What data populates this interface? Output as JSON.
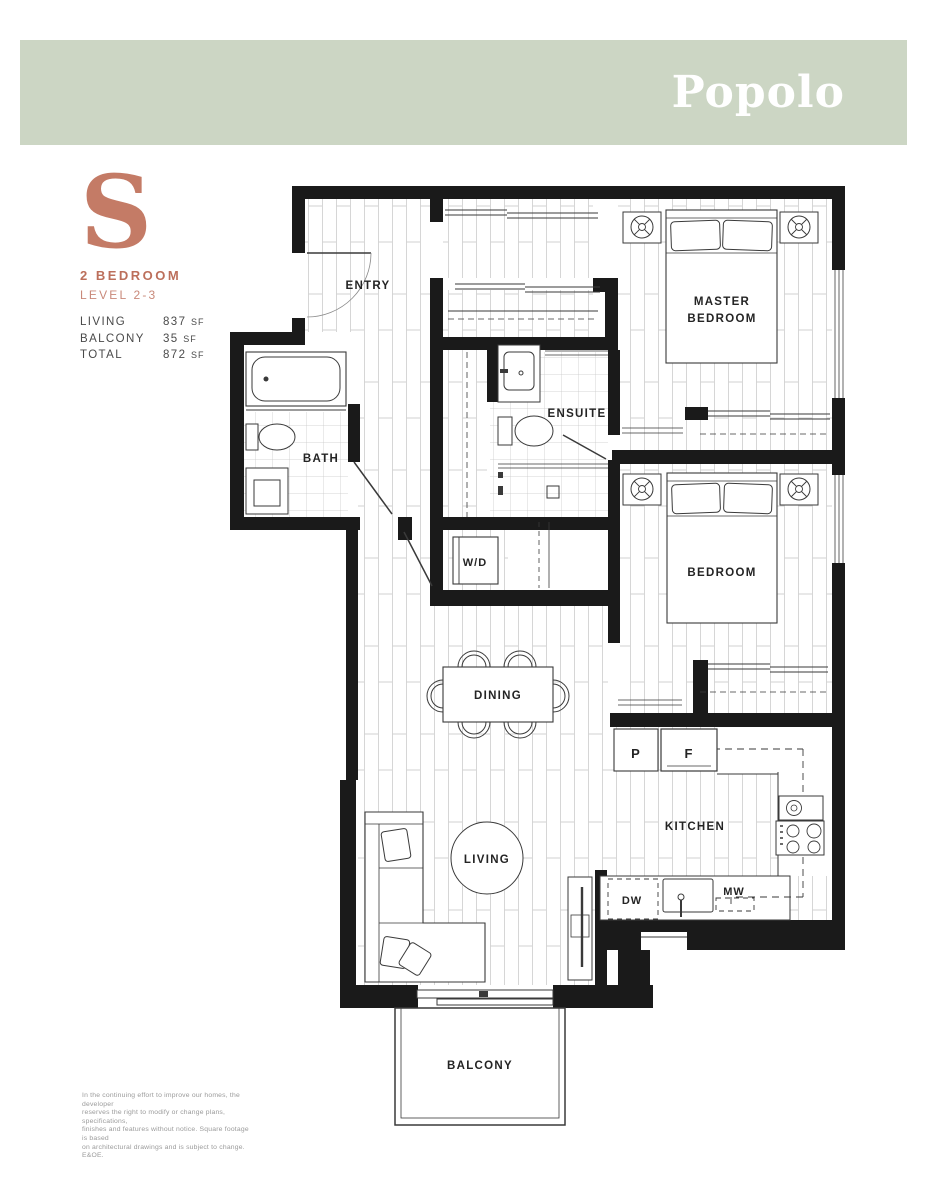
{
  "theme": {
    "banner_green": "#ccd6c4",
    "accent_terracotta": "#c47b66",
    "accent_terracotta_dark": "#bc6f5b",
    "accent_terracotta_light": "#c9897a",
    "wall_black": "#1a1a1a"
  },
  "header": {
    "brand": "Popolo"
  },
  "unit": {
    "letter": "S",
    "type": "2 BEDROOM",
    "level": "LEVEL 2-3"
  },
  "stats": {
    "rows": [
      {
        "label": "LIVING",
        "value": "837",
        "unit": "SF"
      },
      {
        "label": "BALCONY",
        "value": "35",
        "unit": "SF"
      },
      {
        "label": "TOTAL",
        "value": "872",
        "unit": "SF"
      }
    ]
  },
  "plan": {
    "rooms": {
      "entry": "ENTRY",
      "bath": "BATH",
      "ensuite": "ENSUITE",
      "wd": "W/D",
      "master_line1": "MASTER",
      "master_line2": "BEDROOM",
      "bedroom": "BEDROOM",
      "dining": "DINING",
      "kitchen": "KITCHEN",
      "living": "LIVING",
      "balcony": "BALCONY"
    },
    "appliances": {
      "pantry": "P",
      "fridge": "F",
      "dishwasher": "DW",
      "microwave": "MW"
    }
  },
  "disclaimer": {
    "line1": "In the continuing effort to improve our homes, the developer",
    "line2": "reserves the right to modify or change plans, specifications,",
    "line3": "finishes and features without notice. Square footage is based",
    "line4": "on architectural drawings and is subject to change. E&OE."
  }
}
